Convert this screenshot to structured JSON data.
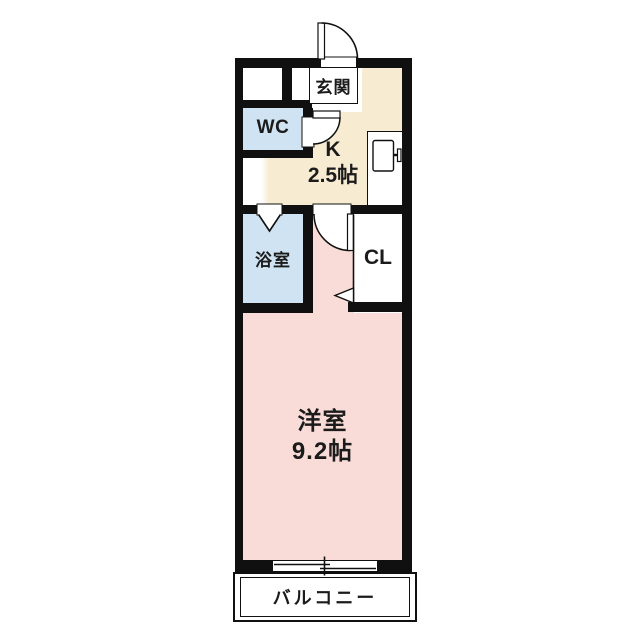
{
  "plan": {
    "rooms": {
      "genkan": {
        "label": "玄関"
      },
      "wc": {
        "label": "WC"
      },
      "kitchen": {
        "label": "K",
        "size": "2.5帖"
      },
      "bath": {
        "label": "浴室"
      },
      "closet": {
        "label": "CL"
      },
      "western_room": {
        "label": "洋室",
        "size": "9.2帖"
      },
      "balcony": {
        "label": "バルコニー"
      }
    },
    "icons": {
      "entrance_door": "quarter-arc door swing",
      "wc_door": "quarter-arc door swing",
      "bath_door": "v-notch folding door",
      "room_door": "quarter-arc door swing",
      "closet_door": "thin line with triangle swing mark",
      "refrigerator": "rectangle with door handle",
      "balcony_window": "offset sliding-sash lines with center tick"
    },
    "colors": {
      "wall": "#101010",
      "kitchen_floor": "#f7ecd2",
      "wet_floor": "#cfe3f2",
      "room_floor": "#f9dcd7"
    }
  }
}
